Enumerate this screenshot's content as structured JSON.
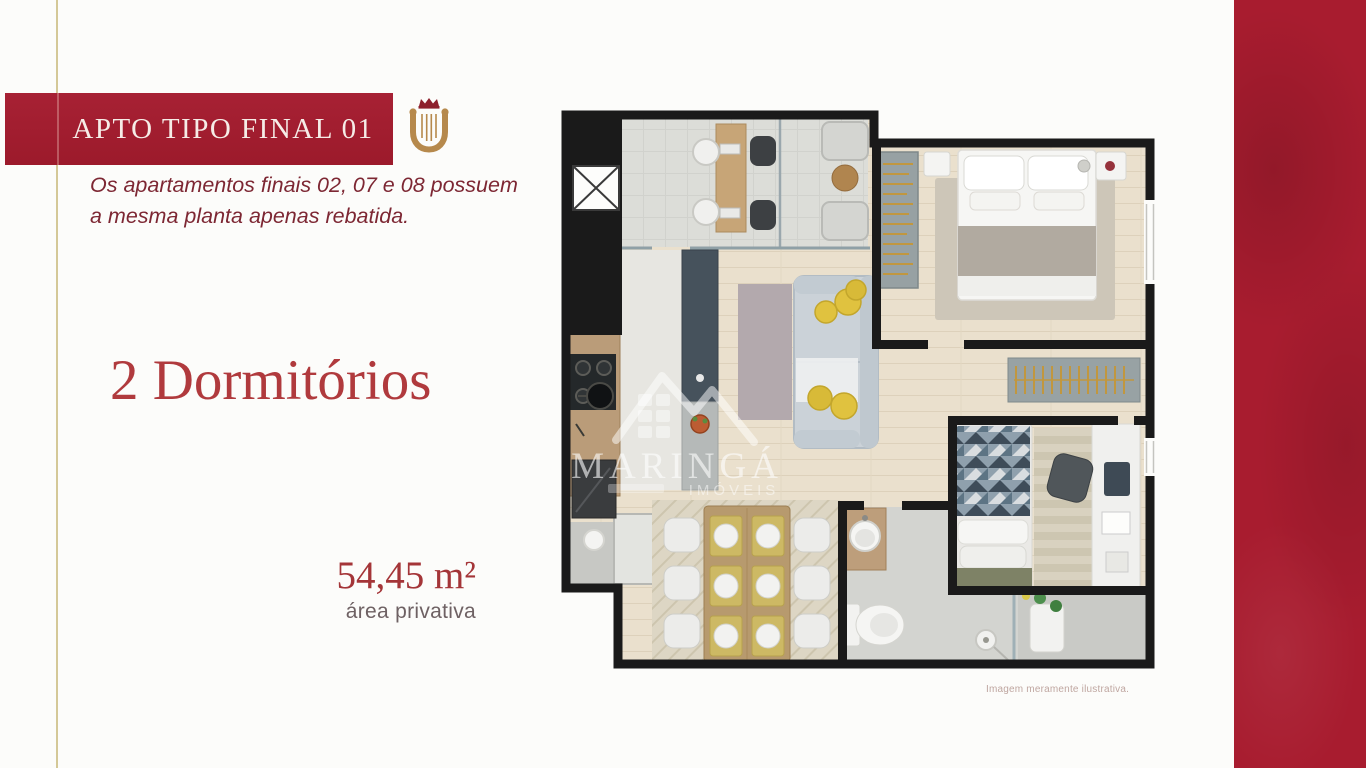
{
  "page": {
    "background_color": "#fcfcfa",
    "gold_line_color": "#d4c897",
    "side_band_color": "#a81c2f",
    "banner_color": "#a21e30"
  },
  "header": {
    "title": "APTO TIPO FINAL 01",
    "subtitle_line1": "Os apartamentos finais 02, 07 e 08 possuem",
    "subtitle_line2": "a mesma planta apenas rebatida.",
    "logo_icon": "crown-lyre-monogram",
    "logo_gold_color": "#b6894c",
    "logo_crown_color": "#8e202c"
  },
  "unit": {
    "bedrooms_label": "2 Dormitórios",
    "area_value": "54,45 m²",
    "area_label": "área privativa"
  },
  "floorplan": {
    "watermark_brand": "MARINGÁ",
    "watermark_tagline": "IMÓVEIS",
    "disclaimer": "Imagem meramente ilustrativa.",
    "wall_color": "#1a1a1a",
    "wood_floor_color": "#eae0cd",
    "accent_yellow": "#e0c23f"
  }
}
